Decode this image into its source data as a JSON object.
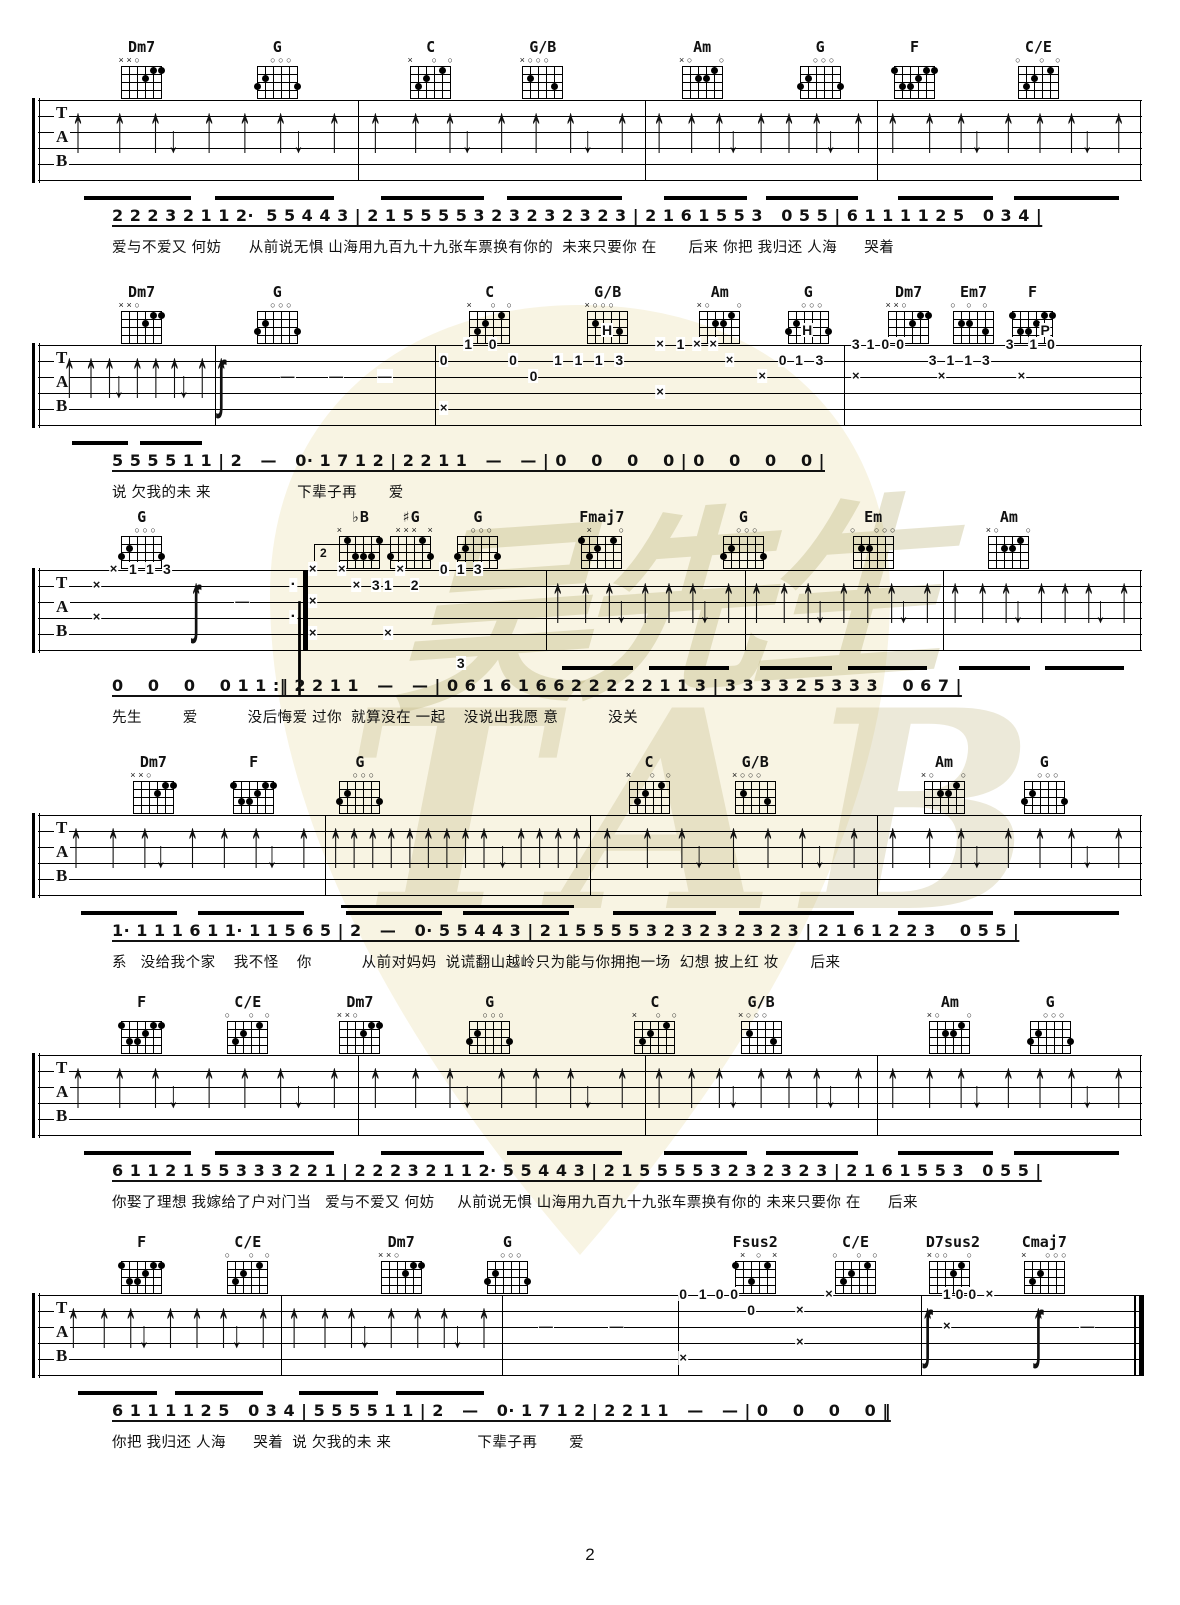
{
  "page": {
    "number": "2"
  },
  "watermark": {
    "cn": "吴先生",
    "latin": "TAB"
  },
  "tab_letters": [
    "T",
    "A",
    "B"
  ],
  "chord_shapes": {
    "Dm7": {
      "tops": [
        "x",
        "x",
        "o",
        "",
        "",
        ""
      ],
      "dots": [
        [
          5,
          1
        ],
        [
          6,
          1
        ],
        [
          4,
          2
        ]
      ]
    },
    "G": {
      "tops": [
        "",
        "",
        "o",
        "o",
        "o",
        ""
      ],
      "dots": [
        [
          2,
          2
        ],
        [
          1,
          3
        ],
        [
          6,
          3
        ]
      ]
    },
    "C": {
      "tops": [
        "x",
        "",
        "",
        "o",
        "",
        "o"
      ],
      "dots": [
        [
          5,
          1
        ],
        [
          3,
          2
        ],
        [
          2,
          3
        ]
      ]
    },
    "G/B": {
      "tops": [
        "x",
        "o",
        "o",
        "o",
        "",
        ""
      ],
      "dots": [
        [
          2,
          2
        ],
        [
          5,
          3
        ]
      ]
    },
    "Am": {
      "tops": [
        "x",
        "o",
        "",
        "",
        "",
        "o"
      ],
      "dots": [
        [
          5,
          1
        ],
        [
          3,
          2
        ],
        [
          4,
          2
        ]
      ]
    },
    "F": {
      "tops": [
        "",
        "",
        "",
        "",
        "",
        ""
      ],
      "dots": [
        [
          1,
          1
        ],
        [
          5,
          1
        ],
        [
          6,
          1
        ],
        [
          4,
          2
        ],
        [
          2,
          3
        ],
        [
          3,
          3
        ]
      ]
    },
    "C/E": {
      "tops": [
        "o",
        "",
        "",
        "o",
        "",
        "o"
      ],
      "dots": [
        [
          5,
          1
        ],
        [
          3,
          2
        ],
        [
          2,
          3
        ]
      ]
    },
    "Em7": {
      "tops": [
        "o",
        "",
        "o",
        "",
        "o",
        ""
      ],
      "dots": [
        [
          2,
          2
        ],
        [
          3,
          2
        ],
        [
          5,
          3
        ]
      ]
    },
    "Fmaj7": {
      "tops": [
        "",
        "x",
        "",
        "",
        "",
        "o"
      ],
      "dots": [
        [
          1,
          1
        ],
        [
          5,
          1
        ],
        [
          3,
          2
        ],
        [
          2,
          3
        ]
      ]
    },
    "Em": {
      "tops": [
        "o",
        "",
        "",
        "o",
        "o",
        "o"
      ],
      "dots": [
        [
          2,
          2
        ],
        [
          3,
          2
        ]
      ]
    },
    "bB": {
      "tops": [
        "x",
        "",
        "",
        "",
        "",
        ""
      ],
      "dots": [
        [
          2,
          1
        ],
        [
          6,
          1
        ],
        [
          3,
          3
        ],
        [
          4,
          3
        ],
        [
          5,
          3
        ]
      ]
    },
    "sG": {
      "tops": [
        "",
        "x",
        "x",
        "x",
        "",
        "x"
      ],
      "dots": [
        [
          5,
          1
        ],
        [
          1,
          3
        ],
        [
          6,
          3
        ]
      ]
    },
    "Fsus2": {
      "tops": [
        "",
        "x",
        "",
        "o",
        "",
        "x"
      ],
      "dots": [
        [
          1,
          1
        ],
        [
          5,
          1
        ],
        [
          3,
          3
        ]
      ]
    },
    "D7sus2": {
      "tops": [
        "x",
        "o",
        "o",
        "",
        "",
        "o"
      ],
      "dots": [
        [
          5,
          1
        ],
        [
          4,
          2
        ]
      ]
    },
    "Cmaj7": {
      "tops": [
        "x",
        "",
        "",
        "o",
        "o",
        "o"
      ],
      "dots": [
        [
          3,
          2
        ],
        [
          2,
          3
        ]
      ]
    }
  },
  "systems": [
    {
      "chords": [
        {
          "name": "Dm7",
          "x": 12.0
        },
        {
          "name": "G",
          "x": 23.5
        },
        {
          "name": "C",
          "x": 36.5
        },
        {
          "name": "G/B",
          "x": 46.0
        },
        {
          "name": "Am",
          "x": 59.5
        },
        {
          "name": "G",
          "x": 69.5
        },
        {
          "name": "F",
          "x": 77.5
        },
        {
          "name": "C/E",
          "x": 88.0
        }
      ],
      "measures": [
        {
          "type": "strum",
          "a": 2,
          "b": 29
        },
        {
          "type": "strum",
          "a": 29,
          "b": 55
        },
        {
          "type": "strum",
          "a": 55,
          "b": 76
        },
        {
          "type": "strum",
          "a": 76,
          "b": 99.8
        }
      ],
      "melody": "2 2 2 3 2 1 1 2·  5 5 4 4 3 | 2 1 5 5 5 5 3 2 3 2 3 2 3 2 3 | 2 1 6 1 5 5 3   0 5 5 | 6 1 1 1 1 2 5   0 3 4 |",
      "lyrics": "爱与不爱又 何妨      从前说无惧 山海用九百九十九张车票换有你的  未来只要你 在       后来 你把 我归还 人海      哭着"
    },
    {
      "chords": [
        {
          "name": "Dm7",
          "x": 12.0
        },
        {
          "name": "G",
          "x": 23.5
        },
        {
          "name": "C",
          "x": 41.5
        },
        {
          "name": "G/B",
          "x": 51.5
        },
        {
          "name": "Am",
          "x": 61.0
        },
        {
          "name": "G",
          "x": 68.5
        },
        {
          "name": "Dm7",
          "x": 77.0
        },
        {
          "name": "Em7",
          "x": 82.5
        },
        {
          "name": "F",
          "x": 87.5
        }
      ],
      "measures": [
        {
          "type": "strum",
          "a": 2,
          "b": 16
        },
        {
          "type": "tokens",
          "a": 16,
          "b": 36,
          "tokens": [
            [
              0.03,
              null,
              "u"
            ],
            [
              0.03,
              null,
              "s"
            ],
            [
              0.33,
              2,
              "-"
            ],
            [
              0.55,
              2,
              "-"
            ],
            [
              0.77,
              2,
              "-"
            ]
          ]
        },
        {
          "type": "tokens",
          "a": 36,
          "b": 73,
          "tokens": [
            [
              0.02,
              1,
              "0"
            ],
            [
              0.08,
              0,
              "1"
            ],
            [
              0.14,
              0,
              "0"
            ],
            [
              0.19,
              1,
              "0"
            ],
            [
              0.24,
              2,
              "0"
            ],
            [
              0.02,
              4,
              "x"
            ],
            [
              0.3,
              1,
              "1"
            ],
            [
              0.35,
              1,
              "1"
            ],
            [
              0.4,
              1,
              "1"
            ],
            [
              0.45,
              1,
              "3"
            ],
            [
              0.42,
              -1,
              "H"
            ],
            [
              0.55,
              0,
              "x"
            ],
            [
              0.6,
              0,
              "1"
            ],
            [
              0.64,
              0,
              "x"
            ],
            [
              0.68,
              0,
              "x"
            ],
            [
              0.72,
              1,
              "x"
            ],
            [
              0.55,
              3,
              "x"
            ],
            [
              0.8,
              2,
              "x"
            ],
            [
              0.85,
              1,
              "0"
            ],
            [
              0.89,
              1,
              "1"
            ],
            [
              0.94,
              1,
              "3"
            ],
            [
              0.91,
              -1,
              "H"
            ]
          ]
        },
        {
          "type": "tokens",
          "a": 73,
          "b": 99.8,
          "tokens": [
            [
              0.04,
              0,
              "3"
            ],
            [
              0.09,
              0,
              "1"
            ],
            [
              0.14,
              0,
              "0"
            ],
            [
              0.19,
              0,
              "0"
            ],
            [
              0.04,
              2,
              "x"
            ],
            [
              0.3,
              1,
              "3"
            ],
            [
              0.36,
              1,
              "1"
            ],
            [
              0.42,
              1,
              "1"
            ],
            [
              0.33,
              2,
              "x"
            ],
            [
              0.48,
              1,
              "3"
            ],
            [
              0.56,
              0,
              "3"
            ],
            [
              0.64,
              0,
              "1"
            ],
            [
              0.7,
              0,
              "0"
            ],
            [
              0.6,
              2,
              "x"
            ],
            [
              0.68,
              -1,
              "P"
            ]
          ]
        }
      ],
      "melody": "5 5 5 5 1 1 | 2   —   0· 1 7 1 2 | 2 2 1 1   —   — | 0    0    0    0 | 0    0    0    0 |",
      "lyrics": "说 欠我的未 来                   下辈子再       爱"
    },
    {
      "chords": [
        {
          "name": "G",
          "x": 12.0
        },
        {
          "name": "♭B",
          "shape": "bB",
          "x": 30.5
        },
        {
          "name": "♯G",
          "shape": "sG",
          "x": 34.8
        },
        {
          "name": "G",
          "x": 40.5
        },
        {
          "name": "Fmaj7",
          "x": 51.0
        },
        {
          "name": "G",
          "x": 63.0
        },
        {
          "name": "Em",
          "x": 74.0
        },
        {
          "name": "Am",
          "x": 85.5
        }
      ],
      "measures": [
        {
          "type": "tokens",
          "a": 2,
          "b": 24,
          "tokens": [
            [
              0.15,
              1,
              "x"
            ],
            [
              0.15,
              3,
              "x"
            ],
            [
              0.22,
              0,
              "x"
            ],
            [
              0.3,
              0,
              "1"
            ],
            [
              0.37,
              0,
              "1"
            ],
            [
              0.44,
              0,
              "3"
            ],
            [
              0.56,
              null,
              "u"
            ],
            [
              0.56,
              null,
              "s"
            ],
            [
              0.75,
              2,
              "-"
            ],
            [
              0.96,
              1,
              "·"
            ],
            [
              0.96,
              3,
              "·"
            ]
          ]
        },
        {
          "type": "tokens",
          "a": 24,
          "b": 46,
          "tokens": [
            [
              0.04,
              0,
              "x"
            ],
            [
              0.04,
              2,
              "x"
            ],
            [
              0.04,
              4,
              "x"
            ],
            [
              0.16,
              0,
              "x"
            ],
            [
              0.22,
              1,
              "x"
            ],
            [
              0.3,
              1,
              "3"
            ],
            [
              0.35,
              1,
              "1"
            ],
            [
              0.4,
              0,
              "x"
            ],
            [
              0.46,
              1,
              "2"
            ],
            [
              0.35,
              4,
              "x"
            ],
            [
              0.58,
              0,
              "0"
            ],
            [
              0.65,
              0,
              "1"
            ],
            [
              0.72,
              0,
              "3"
            ],
            [
              0.65,
              6,
              "3"
            ]
          ]
        },
        {
          "type": "strum",
          "a": 46,
          "b": 64
        },
        {
          "type": "strum",
          "a": 64,
          "b": 82
        },
        {
          "type": "strum",
          "a": 82,
          "b": 99.8
        }
      ],
      "annotations": [
        {
          "t": "repeat",
          "x": 24
        },
        {
          "t": "volta",
          "x": 25,
          "label": "2"
        }
      ],
      "melody": "0    0    0    0 1 1 :‖ 2 2 1 1   —   — | 0 6 1 6 1 6 6 2 2 2 2 2 1 1 3 | 3 3 3 3 2 5 3 3 3    0 6 7 |",
      "lyrics": "先生         爱           没后悔爱 过你  就算没在 一起    没说出我愿 意           没关"
    },
    {
      "chords": [
        {
          "name": "Dm7",
          "x": 13.0
        },
        {
          "name": "F",
          "x": 21.5
        },
        {
          "name": "G",
          "x": 30.5
        },
        {
          "name": "C",
          "x": 55.0
        },
        {
          "name": "G/B",
          "x": 64.0
        },
        {
          "name": "Am",
          "x": 80.0
        },
        {
          "name": "G",
          "x": 88.5
        }
      ],
      "measures": [
        {
          "type": "strum",
          "a": 2,
          "b": 26
        },
        {
          "type": "strum16",
          "a": 26,
          "b": 50
        },
        {
          "type": "strum",
          "a": 50,
          "b": 76
        },
        {
          "type": "strum",
          "a": 76,
          "b": 99.8
        }
      ],
      "melody": "1· 1 1 1 6 1 1· 1 1 5 6 5 | 2   —   0· 5 5 4 4 3 | 2 1 5 5 5 5 3 2 3 2 3 2 3 2 3 | 2 1 6 1 2 2 3    0 5 5 |",
      "lyrics": "系   没给我个家    我不怪    你           从前对妈妈  说谎翻山越岭只为能与你拥抱一场  幻想 披上红 妆       后来"
    },
    {
      "chords": [
        {
          "name": "F",
          "x": 12.0
        },
        {
          "name": "C/E",
          "x": 21.0
        },
        {
          "name": "Dm7",
          "x": 30.5
        },
        {
          "name": "G",
          "x": 41.5
        },
        {
          "name": "C",
          "x": 55.5
        },
        {
          "name": "G/B",
          "x": 64.5
        },
        {
          "name": "Am",
          "x": 80.5
        },
        {
          "name": "G",
          "x": 89.0
        }
      ],
      "measures": [
        {
          "type": "strum",
          "a": 2,
          "b": 29
        },
        {
          "type": "strum",
          "a": 29,
          "b": 55
        },
        {
          "type": "strum",
          "a": 55,
          "b": 76
        },
        {
          "type": "strum",
          "a": 76,
          "b": 99.8
        }
      ],
      "melody": "6 1 1 2 1 5 5 3 3 3 2 2 1 | 2 2 2 3 2 1 1 2· 5 5 4 4 3 | 2 1 5 5 5 5 3 2 3 2 3 2 3 | 2 1 6 1 5 5 3   0 5 5 |",
      "lyrics": "你娶了理想 我嫁给了户对门当   爱与不爱又 何妨     从前说无惧 山海用九百九十九张车票换有你的 未来只要你 在      后来"
    },
    {
      "chords": [
        {
          "name": "F",
          "x": 12.0
        },
        {
          "name": "C/E",
          "x": 21.0
        },
        {
          "name": "Dm7",
          "x": 34.0
        },
        {
          "name": "G",
          "x": 43.0
        },
        {
          "name": "Fsus2",
          "x": 64.0
        },
        {
          "name": "C/E",
          "x": 72.5
        },
        {
          "name": "D7sus2",
          "x": 80.5
        },
        {
          "name": "Cmaj7",
          "x": 88.5
        }
      ],
      "measures": [
        {
          "type": "strum",
          "a": 2,
          "b": 22
        },
        {
          "type": "strum",
          "a": 22,
          "b": 42
        },
        {
          "type": "tokens",
          "a": 42,
          "b": 58,
          "tokens": [
            [
              0.25,
              2,
              "-"
            ],
            [
              0.65,
              2,
              "-"
            ]
          ]
        },
        {
          "type": "tokens",
          "a": 58,
          "b": 80,
          "tokens": [
            [
              0.02,
              0,
              "0"
            ],
            [
              0.1,
              0,
              "1"
            ],
            [
              0.17,
              0,
              "0"
            ],
            [
              0.23,
              0,
              "0"
            ],
            [
              0.3,
              1,
              "0"
            ],
            [
              0.02,
              4,
              "x"
            ],
            [
              0.5,
              1,
              "x"
            ],
            [
              0.5,
              3,
              "x"
            ],
            [
              0.62,
              0,
              "x"
            ]
          ]
        },
        {
          "type": "tokens",
          "a": 80,
          "b": 99.3,
          "tokens": [
            [
              0.03,
              null,
              "u"
            ],
            [
              0.03,
              null,
              "s"
            ],
            [
              0.12,
              0,
              "1"
            ],
            [
              0.18,
              0,
              "0"
            ],
            [
              0.24,
              0,
              "0"
            ],
            [
              0.32,
              0,
              "x"
            ],
            [
              0.12,
              2,
              "x"
            ],
            [
              0.55,
              null,
              "u"
            ],
            [
              0.55,
              null,
              "s"
            ],
            [
              0.78,
              2,
              "-"
            ]
          ]
        }
      ],
      "annotations": [
        {
          "t": "final",
          "x": 100
        }
      ],
      "melody": "6 1 1 1 1 2 5   0 3 4 | 5 5 5 5 1 1 | 2   —   0· 1 7 1 2 | 2 2 1 1   —   — | 0    0    0    0 ‖",
      "lyrics": "你把 我归还 人海      哭着  说 欠我的未 来                   下辈子再       爱"
    }
  ]
}
